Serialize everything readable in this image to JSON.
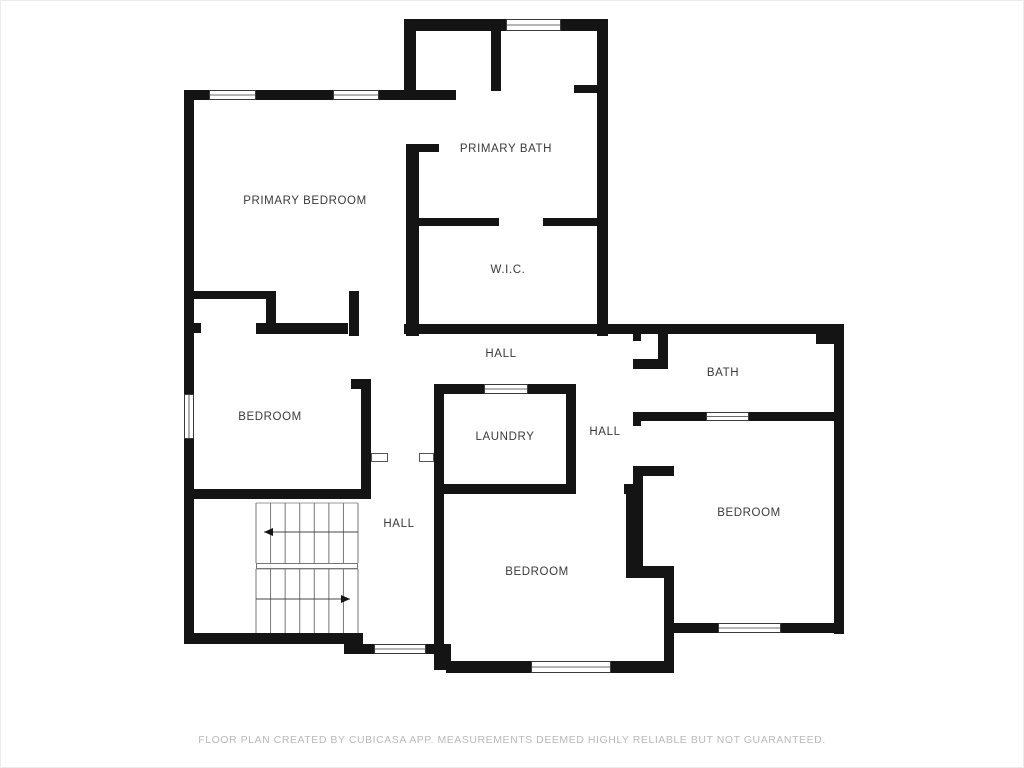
{
  "page": {
    "background": "#ffffff",
    "border_color": "#ececec"
  },
  "floor_plan": {
    "wall_color": "#141414",
    "label_color": "#3a3a3a",
    "stair_line_color": "#777777",
    "window_stroke": "#3a3a3a",
    "door_marker_stroke": "#555555",
    "rooms": [
      {
        "id": "primary-bedroom",
        "label": "PRIMARY BEDROOM",
        "x": 304,
        "y": 203
      },
      {
        "id": "primary-bath",
        "label": "PRIMARY BATH",
        "x": 505,
        "y": 151
      },
      {
        "id": "wic",
        "label": "W.I.C.",
        "x": 507,
        "y": 272
      },
      {
        "id": "hall-top",
        "label": "HALL",
        "x": 500,
        "y": 356
      },
      {
        "id": "bath",
        "label": "BATH",
        "x": 722,
        "y": 375
      },
      {
        "id": "bedroom-left",
        "label": "BEDROOM",
        "x": 269,
        "y": 419
      },
      {
        "id": "laundry",
        "label": "LAUNDRY",
        "x": 504,
        "y": 439
      },
      {
        "id": "hall-right",
        "label": "HALL",
        "x": 604,
        "y": 434
      },
      {
        "id": "bedroom-right",
        "label": "BEDROOM",
        "x": 748,
        "y": 515
      },
      {
        "id": "bedroom-bottom",
        "label": "BEDROOM",
        "x": 536,
        "y": 574
      },
      {
        "id": "hall-bottom",
        "label": "HALL",
        "x": 398,
        "y": 526
      }
    ],
    "walls": [
      [
        403,
        18,
        102,
        12
      ],
      [
        560,
        18,
        47,
        12
      ],
      [
        403,
        18,
        12,
        80
      ],
      [
        490,
        26,
        10,
        64
      ],
      [
        596,
        18,
        11,
        317
      ],
      [
        573,
        84,
        23,
        8
      ],
      [
        185,
        89,
        23,
        10
      ],
      [
        255,
        89,
        77,
        10
      ],
      [
        378,
        89,
        77,
        10
      ],
      [
        183,
        89,
        10,
        304
      ],
      [
        183,
        438,
        10,
        205
      ],
      [
        405,
        143,
        13,
        192
      ],
      [
        418,
        143,
        20,
        8
      ],
      [
        413,
        217,
        85,
        8
      ],
      [
        542,
        217,
        65,
        8
      ],
      [
        403,
        323,
        440,
        10
      ],
      [
        815,
        323,
        28,
        20
      ],
      [
        833,
        333,
        10,
        300
      ],
      [
        193,
        290,
        80,
        8
      ],
      [
        265,
        290,
        10,
        38
      ],
      [
        189,
        322,
        11,
        10
      ],
      [
        255,
        322,
        92,
        11
      ],
      [
        348,
        290,
        10,
        45
      ],
      [
        350,
        378,
        20,
        10
      ],
      [
        360,
        383,
        10,
        115
      ],
      [
        190,
        488,
        180,
        10
      ],
      [
        433,
        383,
        10,
        262
      ],
      [
        433,
        383,
        50,
        10
      ],
      [
        527,
        383,
        48,
        10
      ],
      [
        565,
        383,
        10,
        100
      ],
      [
        433,
        483,
        142,
        10
      ],
      [
        632,
        328,
        8,
        12
      ],
      [
        657,
        333,
        10,
        35
      ],
      [
        632,
        358,
        35,
        10
      ],
      [
        632,
        411,
        73,
        9
      ],
      [
        748,
        411,
        85,
        9
      ],
      [
        632,
        411,
        8,
        14
      ],
      [
        632,
        465,
        41,
        10
      ],
      [
        632,
        465,
        10,
        112
      ],
      [
        623,
        485,
        9,
        8
      ],
      [
        625,
        565,
        48,
        12
      ],
      [
        663,
        565,
        10,
        100
      ],
      [
        623,
        483,
        12,
        10
      ],
      [
        625,
        483,
        10,
        94
      ],
      [
        445,
        660,
        85,
        12
      ],
      [
        610,
        660,
        63,
        12
      ],
      [
        183,
        632,
        172,
        11
      ],
      [
        343,
        632,
        19,
        21
      ],
      [
        358,
        643,
        15,
        10
      ],
      [
        425,
        643,
        25,
        10
      ],
      [
        433,
        643,
        17,
        26
      ],
      [
        673,
        622,
        44,
        10
      ],
      [
        780,
        622,
        57,
        10
      ]
    ],
    "windows": [
      [
        505,
        18,
        55,
        12,
        "h"
      ],
      [
        208,
        89,
        47,
        10,
        "h"
      ],
      [
        332,
        89,
        46,
        10,
        "h"
      ],
      [
        183,
        393,
        10,
        45,
        "v"
      ],
      [
        483,
        383,
        44,
        10,
        "h"
      ],
      [
        705,
        411,
        43,
        9,
        "h"
      ],
      [
        717,
        622,
        63,
        10,
        "h"
      ],
      [
        530,
        660,
        80,
        12,
        "h"
      ],
      [
        373,
        643,
        52,
        10,
        "h"
      ]
    ],
    "door_markers": [
      [
        370,
        452,
        17,
        9
      ],
      [
        418,
        452,
        15,
        9
      ]
    ],
    "stairs": {
      "x1": 255,
      "x2": 357,
      "num_lines": 8,
      "flights": [
        {
          "y1": 502,
          "y2": 562
        },
        {
          "y1": 568,
          "y2": 632
        }
      ],
      "landing": {
        "x": 255,
        "y": 562,
        "w": 102,
        "h": 6
      },
      "arrows": [
        {
          "y": 531,
          "x1": 263,
          "x2": 357,
          "head": "left"
        },
        {
          "y": 598,
          "x1": 255,
          "x2": 349,
          "head": "right"
        }
      ]
    },
    "footer": {
      "text": "FLOOR PLAN CREATED BY CUBICASA APP. MEASUREMENTS DEEMED HIGHLY RELIABLE BUT NOT GUARANTEED."
    }
  }
}
